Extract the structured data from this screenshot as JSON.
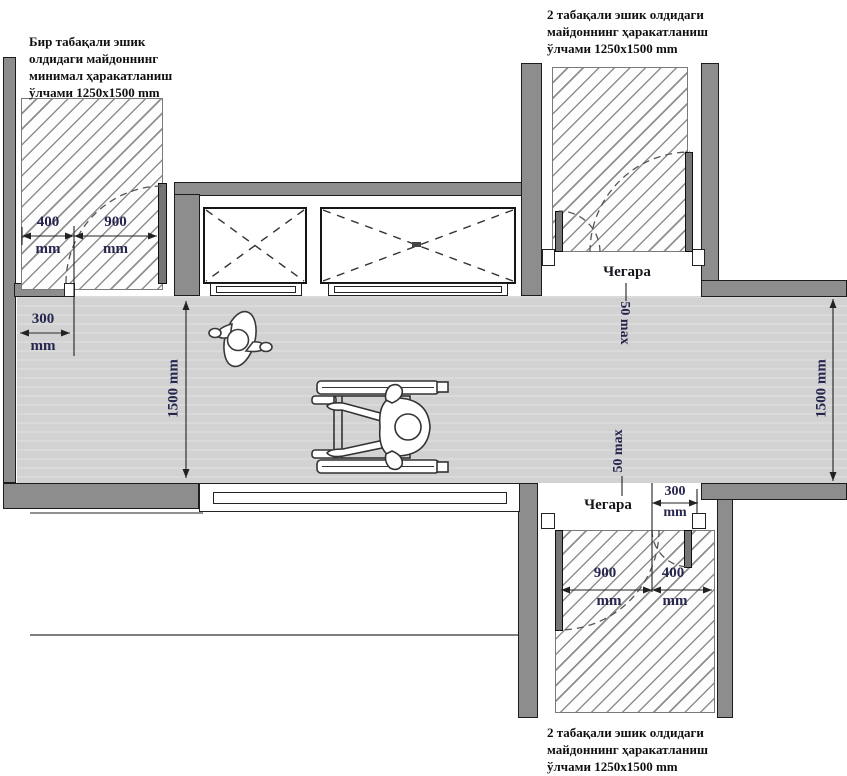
{
  "annotations": {
    "top_left": {
      "line1": "Бир табақали эшик",
      "line2": "олдидаги майдоннинг",
      "line3": "минимал ҳаракатланиш",
      "line4": "ўлчами 1250x1500 mm"
    },
    "top_right": {
      "line1": "2 табақали эшик олдидаги",
      "line2": "майдоннинг ҳаракатланиш",
      "line3": "ўлчами 1250x1500 mm"
    },
    "bottom_right": {
      "line1": "2 табақали эшик олдидаги",
      "line2": "майдоннинг ҳаракатланиш",
      "line3": "ўлчами 1250x1500 mm"
    }
  },
  "dimensions": {
    "door_top_left": {
      "d400": "400",
      "d400_unit": "mm",
      "d900": "900",
      "d900_unit": "mm",
      "d300": "300",
      "d300_unit": "mm"
    },
    "corridor": {
      "width_left": "1500 mm",
      "width_right": "1500 mm",
      "threshold_top": "50 max",
      "threshold_bottom": "50 max"
    },
    "door_bottom_right": {
      "d300": "300",
      "d300_unit": "mm",
      "d900": "900",
      "d900_unit": "mm",
      "d400": "400",
      "d400_unit": "mm"
    },
    "boundary_top": "Чегара",
    "boundary_bottom": "Чегара"
  },
  "colors": {
    "wall": "#8d8d8d",
    "floor": "#d2d2d2",
    "hatch_line": "#8f8f8f",
    "dimension_text": "#26264f",
    "annotation_text": "#101010"
  }
}
